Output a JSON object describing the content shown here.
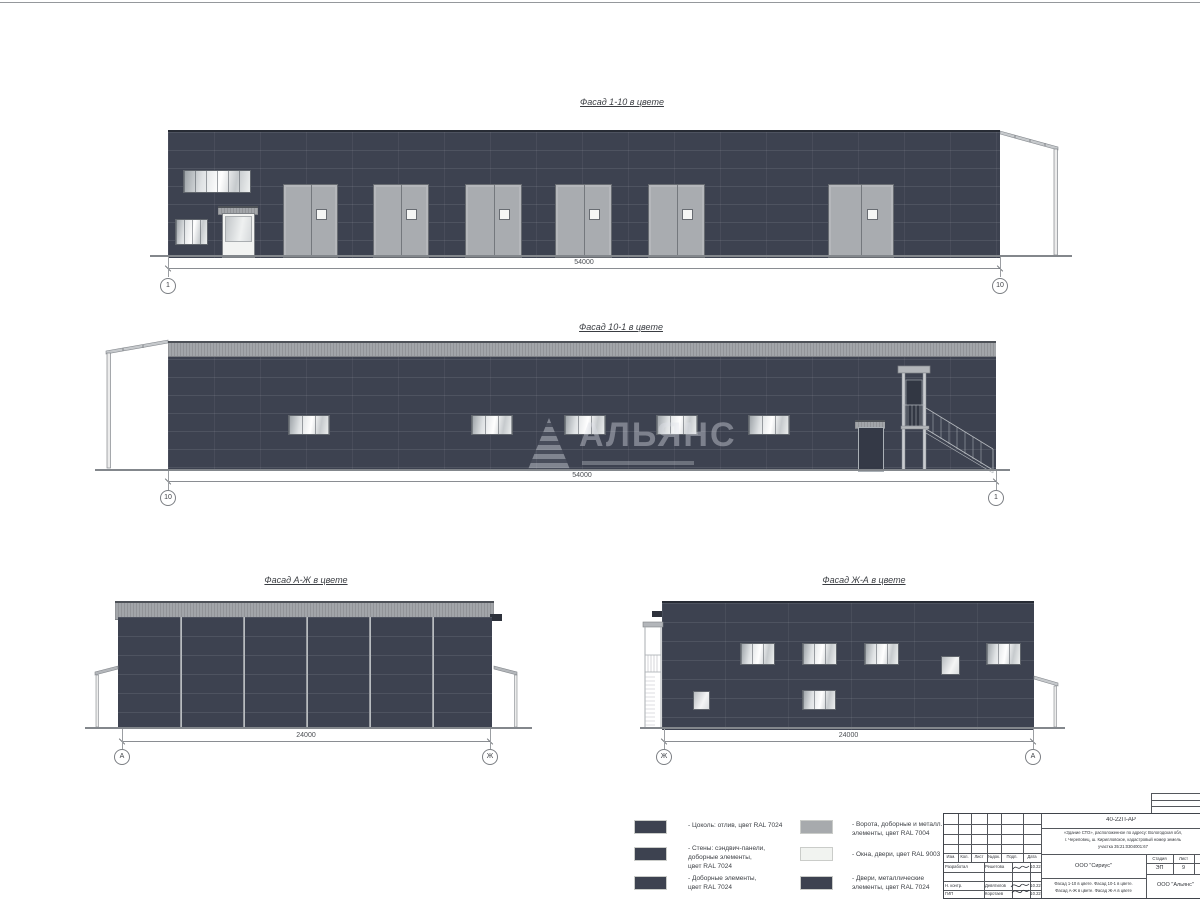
{
  "facades": [
    {
      "title": "Фасад 1-10 в цвете",
      "dimension": "54000",
      "axis_left": "1",
      "axis_right": "10"
    },
    {
      "title": "Фасад 10-1 в цвете",
      "dimension": "54000",
      "axis_left": "10",
      "axis_right": "1"
    },
    {
      "title": "Фасад А-Ж в цвете",
      "dimension": "24000",
      "axis_left": "А",
      "axis_right": "Ж"
    },
    {
      "title": "Фасад Ж-А в цвете",
      "dimension": "24000",
      "axis_left": "Ж",
      "axis_right": "А"
    }
  ],
  "watermark": {
    "text": "АЛЬЯНС"
  },
  "colors": {
    "wall_ral7024": "#3d4250",
    "gate_ral7004": "#a7aaad",
    "white_ral9003": "#f1f3f0"
  },
  "legend": {
    "items": [
      {
        "label": "- Цоколь: отлив, цвет RAL 7024",
        "color": "#3d4250"
      },
      {
        "label": "- Стены: сэндвич-панели,\nдоборные элементы,\nцвет RAL 7024",
        "color": "#3d4250"
      },
      {
        "label": "- Доборные элементы,\nцвет RAL 7024",
        "color": "#3d4250"
      },
      {
        "label": "- Ворота, доборные и металл.\nэлементы, цвет RAL 7004",
        "color": "#a7aaad"
      },
      {
        "label": "- Окна, двери, цвет RAL 9003",
        "color": "#f1f3f0"
      },
      {
        "label": "- Двери, металлические\nэлементы, цвет RAL 7024",
        "color": "#3d4250"
      }
    ]
  },
  "title_block": {
    "code": "40-22П-АР",
    "project": "«Здание СТО», расположенное по адресу: Вологодская обл,\nг. Череповец, ш. Кирилловское, кадастровый номер земель\nучастка 35:21:0304001:67",
    "columns": [
      "Изм.",
      "Кол.",
      "Лист",
      "№док.",
      "Подп.",
      "Дата"
    ],
    "rows": [
      {
        "role": "Разработал",
        "name": "Решетова",
        "date": "10.22"
      },
      {
        "role": "Н. контр.",
        "name": "Девятилов",
        "date": "10.22"
      },
      {
        "role": "ГИП",
        "name": "Коротаев",
        "date": "10.22"
      }
    ],
    "customer": "ООО \"Сириус\"",
    "stage_label": "Стадия",
    "sheet_label": "Лист",
    "stage": "ЭП",
    "sheet_number": "9",
    "content": "Фасад 1-10 в цвете. Фасад 10-1 в цвете.\nФасад А-Ж в цвете. Фасад Ж-А в цвете",
    "organization": "ООО \"Альянс\""
  }
}
